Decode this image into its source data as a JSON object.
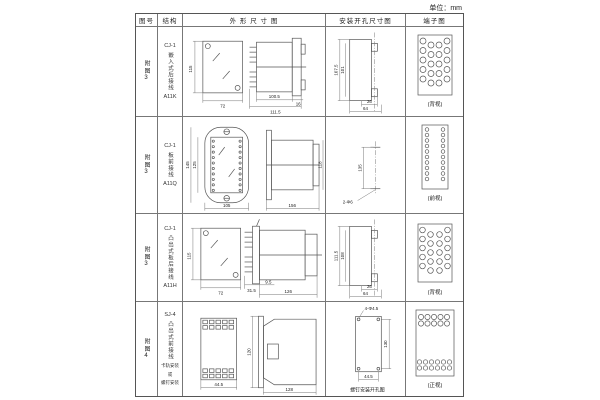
{
  "unit_label": "单位：mm",
  "header": {
    "cols": [
      "图号",
      "结构",
      "外 形 尺 寸 图",
      "安装开孔尺寸图",
      "端子图"
    ]
  },
  "rows": [
    {
      "figure_no": "附图3",
      "structure": {
        "model": "CJ-1",
        "name": "嵌入式后接线",
        "code": "A11K"
      },
      "outline": {
        "d1": "115",
        "d2": "72",
        "d3": "100.5",
        "d4": "111.5",
        "d5": "16"
      },
      "mounting": {
        "d1": "107.5",
        "d2": "101",
        "d3": "26",
        "d4": "64"
      },
      "terminal": {
        "view_label": "(背视)"
      }
    },
    {
      "figure_no": "附图3",
      "structure": {
        "model": "CJ-1",
        "name": "板前接线",
        "code": "A11Q"
      },
      "outline": {
        "d1": "145",
        "d2": "125",
        "d3": "105",
        "d4": "156",
        "d5": "118"
      },
      "mounting": {
        "d1": "135",
        "hole_label": "2-Φ6"
      },
      "terminal": {
        "view_label": "(前视)"
      }
    },
    {
      "figure_no": "附图3",
      "structure": {
        "model": "CJ-1",
        "name": "凸出式板后接线",
        "code": "A11H"
      },
      "outline": {
        "d1": "115",
        "d2": "72",
        "d3": "31.5",
        "d4": "9.5",
        "d5": "126"
      },
      "mounting": {
        "d1": "111.5",
        "d2": "108",
        "d3": "26",
        "d4": "64"
      },
      "terminal": {
        "view_label": "(背视)"
      }
    },
    {
      "figure_no": "附图4",
      "structure": {
        "model": "SJ-4",
        "name": "凸出式前接线",
        "note1": "卡轨安装",
        "note2": "或",
        "note3": "螺钉安装"
      },
      "outline": {
        "d1": "44.5",
        "d2": "120",
        "d3": "128"
      },
      "mounting": {
        "hole_label": "4-Φ4.5",
        "d1": "130",
        "d2": "44.5",
        "caption": "螺钉安装开孔图"
      },
      "terminal": {
        "view_label": "(正视)"
      }
    }
  ]
}
